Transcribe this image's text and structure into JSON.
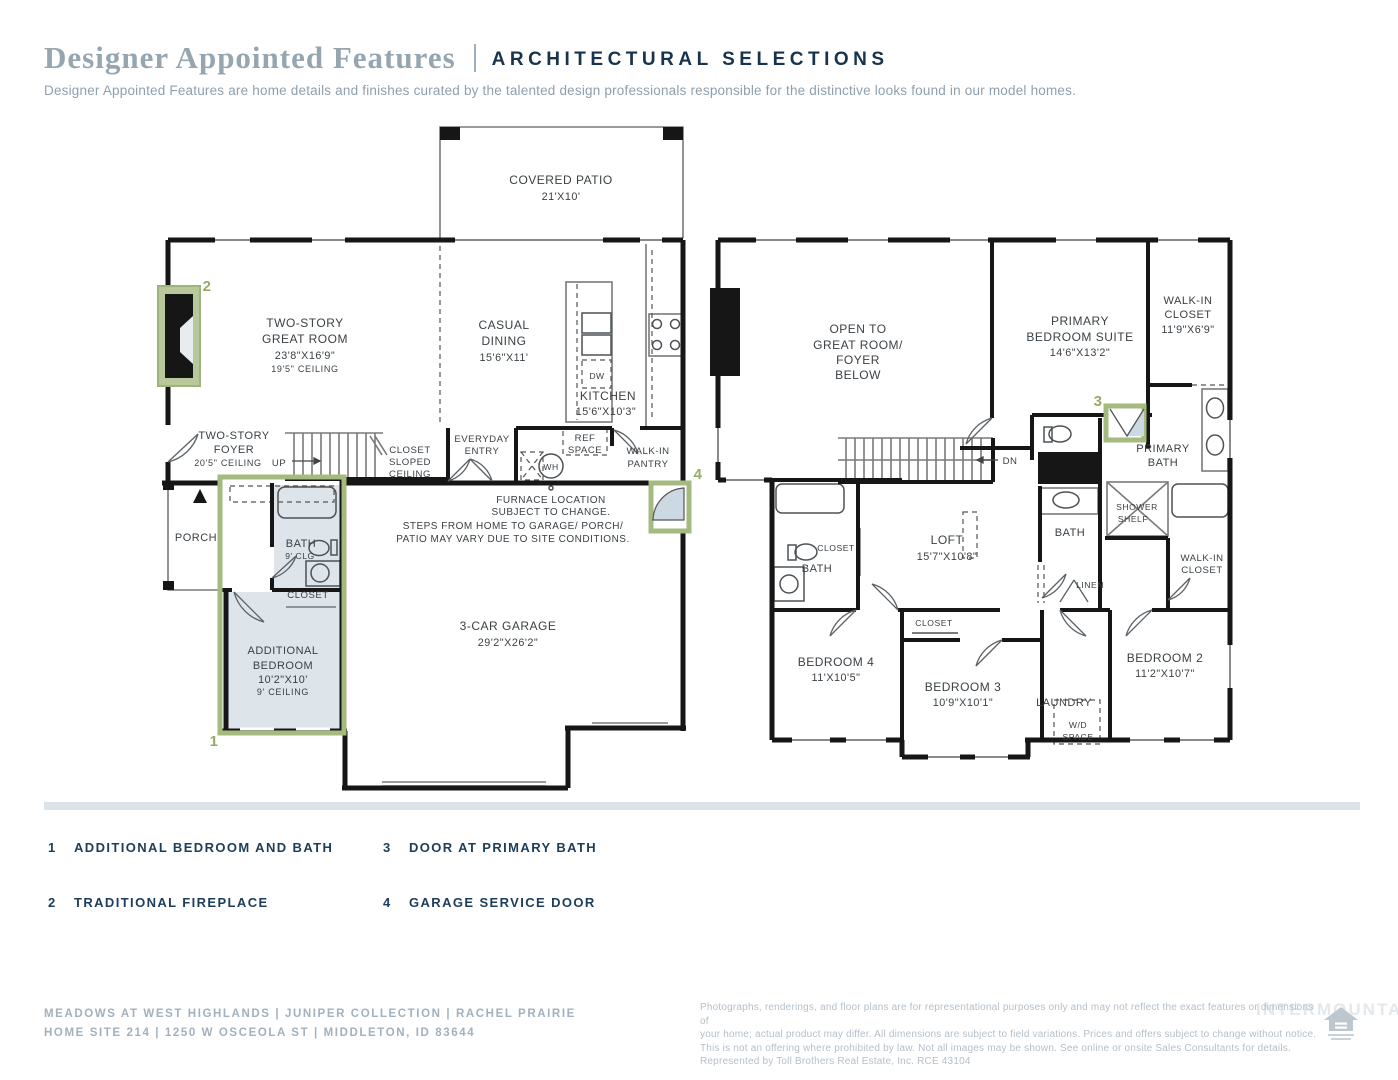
{
  "header": {
    "title": "Designer Appointed Features",
    "subtitle": "ARCHITECTURAL SELECTIONS",
    "description": "Designer Appointed Features are home details and finishes curated by the talented design professionals responsible for the distinctive looks found in our model homes."
  },
  "colors": {
    "accent_green": "#a5ba7f",
    "navy": "#1c3d5c",
    "room_highlight": "#dde4ea",
    "wall": "#161616"
  },
  "f1": {
    "patio": {
      "l1": "COVERED PATIO",
      "l2": "21'X10'"
    },
    "great": {
      "l1": "TWO-STORY",
      "l2": "GREAT ROOM",
      "l3": "23'8\"X16'9\"",
      "l4": "19'5\" CEILING"
    },
    "dining": {
      "l1": "CASUAL",
      "l2": "DINING",
      "l3": "15'6\"X11'"
    },
    "kitchen": {
      "l1": "KITCHEN",
      "l2": "15'6\"X10'3\""
    },
    "dw": "DW",
    "foyer": {
      "l1": "TWO-STORY",
      "l2": "FOYER",
      "l3": "20'5\" CEILING"
    },
    "up": "UP",
    "closet_sloped": {
      "l1": "CLOSET",
      "l2": "SLOPED",
      "l3": "CEILING"
    },
    "entry": {
      "l1": "EVERYDAY",
      "l2": "ENTRY"
    },
    "ref": {
      "l1": "REF",
      "l2": "SPACE"
    },
    "pantry": {
      "l1": "WALK-IN",
      "l2": "PANTRY"
    },
    "wh": "WH",
    "furnace": {
      "l1": "FURNACE LOCATION",
      "l2": "SUBJECT TO CHANGE."
    },
    "steps": {
      "l1": "STEPS FROM HOME TO GARAGE/ PORCH/",
      "l2": "PATIO MAY VARY DUE TO SITE CONDITIONS."
    },
    "porch": "PORCH",
    "bath": {
      "l1": "BATH",
      "l2": "9' CLG"
    },
    "closet": "CLOSET",
    "addbed": {
      "l1": "ADDITIONAL",
      "l2": "BEDROOM",
      "l3": "10'2\"X10'",
      "l4": "9' CEILING"
    },
    "garage": {
      "l1": "3-CAR GARAGE",
      "l2": "29'2\"X26'2\""
    },
    "m1": "1",
    "m2": "2",
    "m4": "4"
  },
  "f2": {
    "open": {
      "l1": "OPEN TO",
      "l2": "GREAT ROOM/",
      "l3": "FOYER",
      "l4": "BELOW"
    },
    "suite": {
      "l1": "PRIMARY",
      "l2": "BEDROOM SUITE",
      "l3": "14'6\"X13'2\""
    },
    "wic1": {
      "l1": "WALK-IN",
      "l2": "CLOSET",
      "l3": "11'9\"X6'9\""
    },
    "pbath": {
      "l1": "PRIMARY",
      "l2": "BATH"
    },
    "dn": "DN",
    "shower": {
      "l1": "SHOWER",
      "l2": "SHELF"
    },
    "bath_mid": "BATH",
    "linen": "LINEN",
    "wic2": {
      "l1": "WALK-IN",
      "l2": "CLOSET"
    },
    "bath_left": "BATH",
    "closet_left": "CLOSET",
    "loft": {
      "l1": "LOFT",
      "l2": "15'7\"X10'8\""
    },
    "bed4": {
      "l1": "BEDROOM 4",
      "l2": "11'X10'5\""
    },
    "closet3": "CLOSET",
    "bed3": {
      "l1": "BEDROOM 3",
      "l2": "10'9\"X10'1\""
    },
    "laundry": "LAUNDRY",
    "wd": {
      "l1": "W/D",
      "l2": "SPACE"
    },
    "bed2": {
      "l1": "BEDROOM 2",
      "l2": "11'2\"X10'7\""
    },
    "m3": "3"
  },
  "legend": {
    "items": [
      {
        "num": "1",
        "label": "ADDITIONAL BEDROOM AND BATH"
      },
      {
        "num": "2",
        "label": "TRADITIONAL FIREPLACE"
      },
      {
        "num": "3",
        "label": "DOOR AT PRIMARY BATH"
      },
      {
        "num": "4",
        "label": "GARAGE SERVICE DOOR"
      }
    ]
  },
  "footer": {
    "community_line1": "MEADOWS AT WEST HIGHLANDS   |   JUNIPER COLLECTION   |   RACHEL PRAIRIE",
    "community_line2": "HOME SITE 214   |   1250 W OSCEOLA ST   |   MIDDLETON, ID 83644",
    "legal_l1": "Photographs, renderings, and floor plans are for representational purposes only and may not reflect the exact features or dimensions of",
    "legal_l2": "your home; actual product may differ. All dimensions are subject to field variations. Prices and offers subject to change without notice.",
    "legal_l3": "This is not an offering where prohibited by law. Not all images may be shown. See online or onsite Sales Consultants for details.",
    "legal_l4": "Represented by Toll Brothers Real Estate, Inc. RCE 43104",
    "watermark": "INTERMOUNTAIN",
    "equal_housing": "EQUAL HOUSING OPPORTUNITY"
  }
}
